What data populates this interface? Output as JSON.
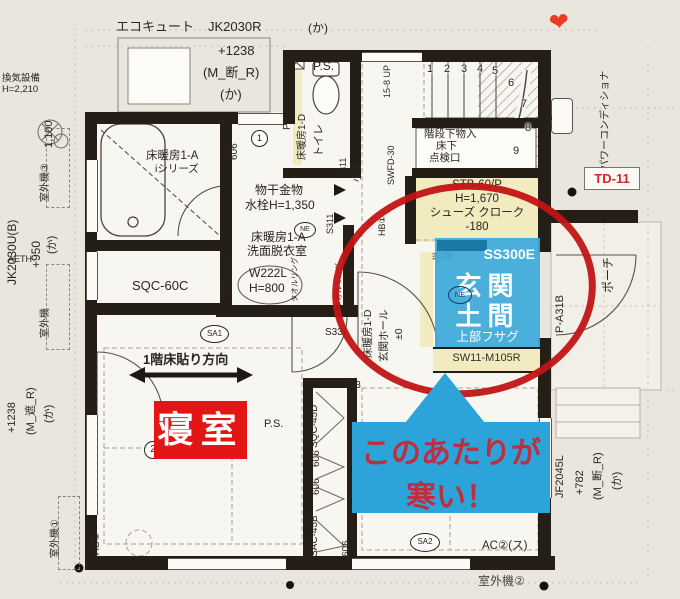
{
  "colors": {
    "annotation_red": "#c11414",
    "annotation_blue": "#2ca4da",
    "badge_red": "#e31515",
    "wall_black": "#241e17",
    "highlight_yellow": "#f3ebc0"
  },
  "annotations": {
    "entrance": {
      "code": "SS300E",
      "line1": "玄関",
      "line2": "土間",
      "note": "上部フサグ"
    },
    "bedroom": "寝室",
    "cold1": "このあたりが",
    "cold2": "寒い！",
    "td11": "TD-11",
    "heart": "❤"
  },
  "plan": {
    "ecocute": "エコキュート",
    "jk2030r": "JK2030R",
    "p1238": "+1238",
    "m_dan_r": "(M_断_R)",
    "ka": "(か)",
    "kanki1": "換気設備",
    "kanki2": "H=2,210",
    "d1100": "1,100",
    "gaiki3": "室外機③",
    "jk2030u": "JK2030U(B)",
    "p950": "+950",
    "aeth": "AETH",
    "gaiki": "室外機",
    "bath_heat": "床暖房1-A",
    "bath_series": "iシリーズ",
    "ps": "P.S.",
    "ph": "PH",
    "toilet_heat": "床暖房1-D",
    "toilet": "トイレ",
    "d606": "606",
    "one": "1",
    "two": "2",
    "s311": "S311",
    "komado": "小窓",
    "swfd30": "SWFD-30",
    "hb1": "HB①",
    "up": "15-8 UP",
    "steps": [
      "1",
      "2",
      "3",
      "4",
      "5",
      "6",
      "7",
      "8",
      "9"
    ],
    "monoire": "階段下物入",
    "yukashita": "床下",
    "tenkenko": "点検口",
    "powercond": "パワーコンディショナ",
    "l1": "①L",
    "monohoshi": "物干金物",
    "suisen": "水栓H=1,350",
    "senmen": "洗面脱衣室",
    "towel": "タオルリング",
    "w222l": "W222L",
    "h800": "H=800",
    "sqc60c": "SQC-60C",
    "sa1": "SA1",
    "ne": "NE",
    "hoko": "1階床貼り方向",
    "ac1": "AC①",
    "gaiki1": "室外機①",
    "m_sha_r": "(M_遮_R)",
    "sqc45d": "SQC-45D",
    "sac45b": "SAC-45B",
    "tesuri": "手摺",
    "ent_heat": "床暖房1-D",
    "ent_hall": "玄関ホール",
    "pm0": "±0",
    "stb": "STB-60/P",
    "h1670": "H=1,670",
    "shoes": "シューズ クローク",
    "m180": "-180",
    "sw11": "SW11-M105R",
    "porch": "ポーチ",
    "pa31b": "P-A31B",
    "s33": "S33",
    "sa2": "SA2",
    "ac2": "AC②(ス)",
    "gaiki2": "室外機②",
    "jf2045l": "JF2045L",
    "p782": "+782"
  }
}
